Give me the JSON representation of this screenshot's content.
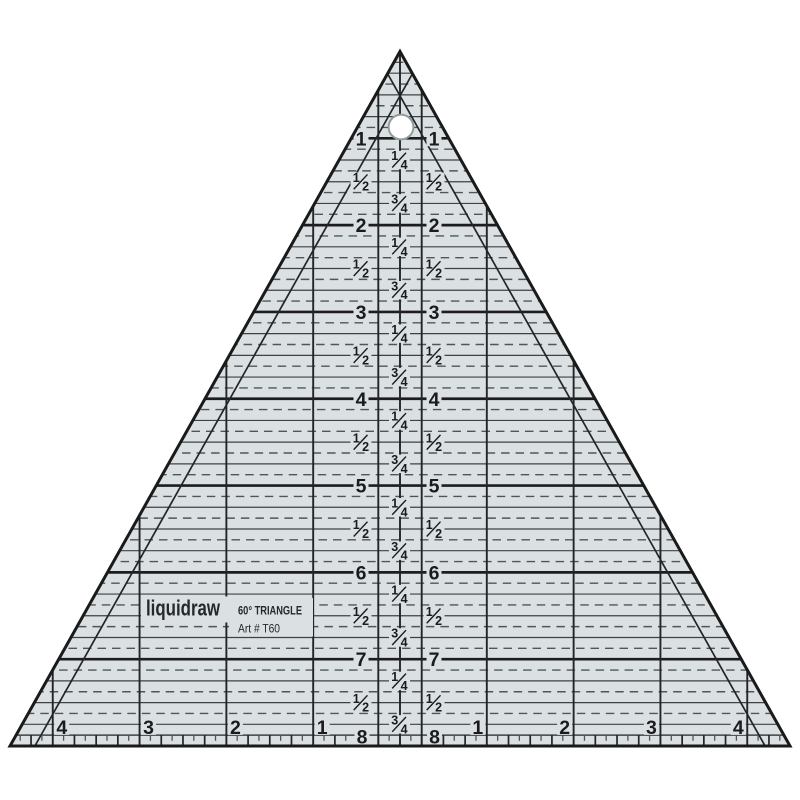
{
  "product": {
    "brand": "liquidraw",
    "title": "60° TRIANGLE",
    "art_number": "Art # T60"
  },
  "ruler_markings": {
    "inch_numbers": [
      "1",
      "2",
      "3",
      "4",
      "5",
      "6",
      "7"
    ],
    "bottom_inch_pair": [
      "8",
      "8"
    ],
    "fraction_quarter": {
      "numerator": "1",
      "denominator": "4"
    },
    "fraction_half": {
      "numerator": "1",
      "denominator": "2"
    },
    "fraction_three_quarter": {
      "numerator": "3",
      "denominator": "4"
    },
    "base_scale_left": [
      "4",
      "3",
      "2",
      "1"
    ],
    "base_scale_right": [
      "1",
      "2",
      "3",
      "4"
    ]
  },
  "colors": {
    "background": "#ffffff",
    "body": "#dbe0e2",
    "edge": "#1a1a1a",
    "line_heavy": "#1d1d1f",
    "line_quarter": "#3e4245",
    "line_dash": "#50555a",
    "line_vertical": "#232527",
    "text": "#1b1b1d",
    "hole_ring": "#939b9e",
    "brand_text": "#26282a"
  }
}
